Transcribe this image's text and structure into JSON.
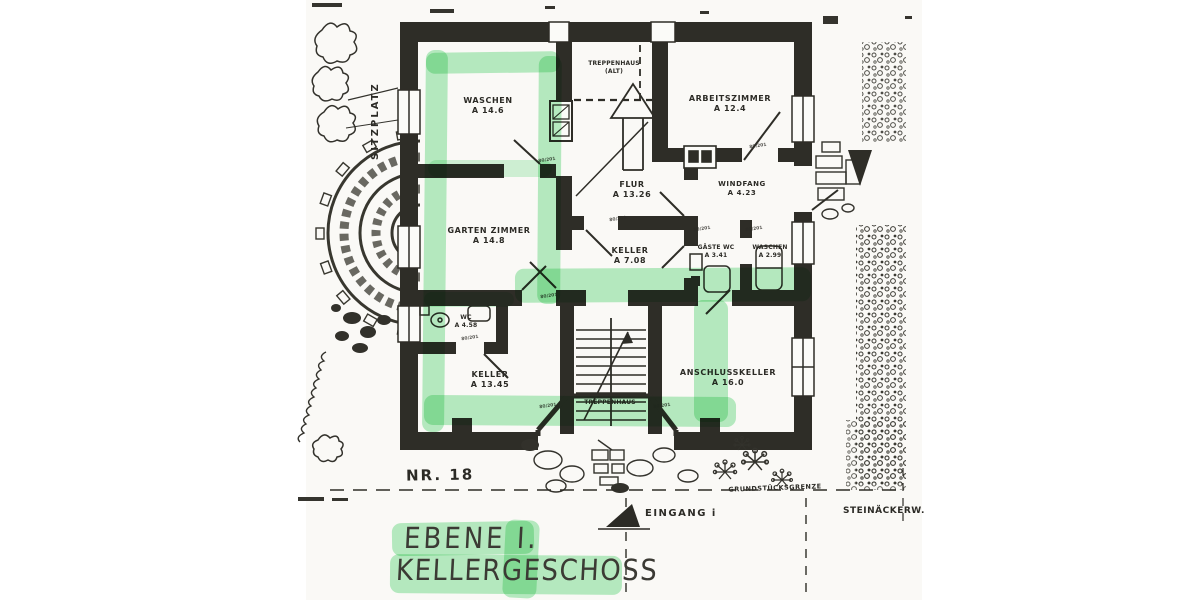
{
  "title": {
    "line1": "EBENE I.",
    "line2": "KELLERGESCHOSS"
  },
  "site": {
    "house_number": "NR. 18",
    "entrance_label": "EINGANG i",
    "property_line_label": "GRUNDSTÜCKSGRENZE",
    "street_label": "STEINÄCKERW.",
    "terrace_label": "SITZPLATZ"
  },
  "rooms": {
    "waschen_og": {
      "name": "WASCHEN",
      "area": "A 14.6"
    },
    "treppenhaus_alt": {
      "name": "TREPPENHAUS",
      "area": "(ALT)"
    },
    "arbeitszimmer": {
      "name": "ARBEITSZIMMER",
      "area": "A 12.4"
    },
    "flur": {
      "name": "FLUR",
      "area": "A 13.26"
    },
    "windfang": {
      "name": "WINDFANG",
      "area": "A 4.23"
    },
    "gartenzimmer": {
      "name": "GARTEN ZIMMER",
      "area": "A 14.8"
    },
    "keller_mitte": {
      "name": "KELLER",
      "area": "A 7.08"
    },
    "gaeste_wc": {
      "name": "GÄSTE WC",
      "area": "A 3.41"
    },
    "waschen_klein": {
      "name": "WASCHEN",
      "area": "A 2.99"
    },
    "wc": {
      "name": "WC",
      "area": "A 4.58"
    },
    "keller_gross": {
      "name": "KELLER",
      "area": "A 13.45"
    },
    "treppenhaus": {
      "name": "TREPPENHAUS",
      "area": ""
    },
    "anschlusskeller": {
      "name": "ANSCHLUSSKELLER",
      "area": "A 16.0"
    }
  },
  "annotations": {
    "door_dim": "80/201"
  },
  "colors": {
    "wall_ink": "#2e2d27",
    "highlighter_green": "#7ee096",
    "paper": "#faf9f6"
  }
}
